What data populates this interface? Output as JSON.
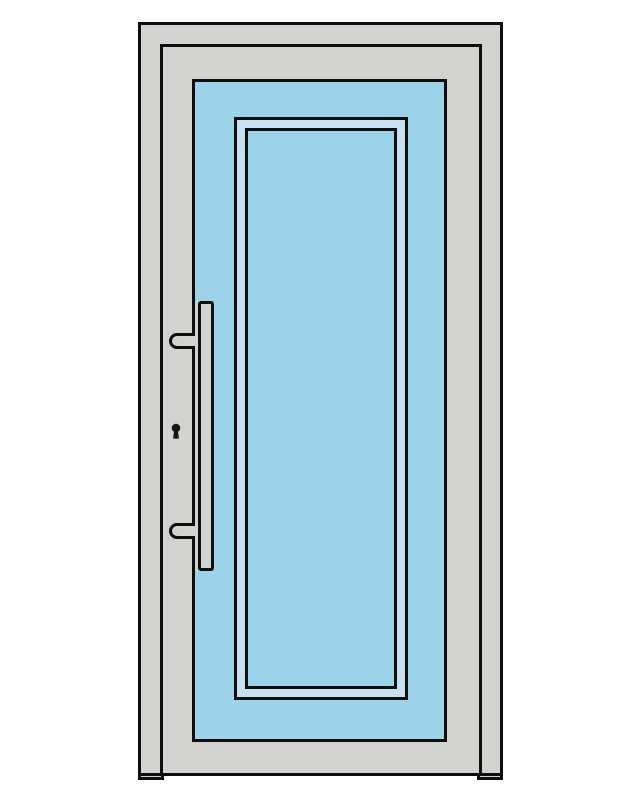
{
  "illustration": {
    "subject": "front-door-product-drawing",
    "parts": {
      "door_frame": "door frame",
      "frame_inner_edge": "frame inner edge",
      "door_leaf": "door leaf",
      "glazing_frame": "glazing beading",
      "glazing_pane": "glass pane",
      "handle_bar": "pull handle bar",
      "handle_mount_top": "handle standoff top",
      "handle_mount_bottom": "handle standoff bottom",
      "keyhole": "keyhole"
    }
  },
  "colors": {
    "background": "#ffffff",
    "outline": "#0e0e0e",
    "frame": "#d2d2d0",
    "leaf": "#9bd3e9",
    "glazing_band": "#c6e2f0",
    "hardware": "#d2d2d0",
    "keyhole": "#161616"
  }
}
